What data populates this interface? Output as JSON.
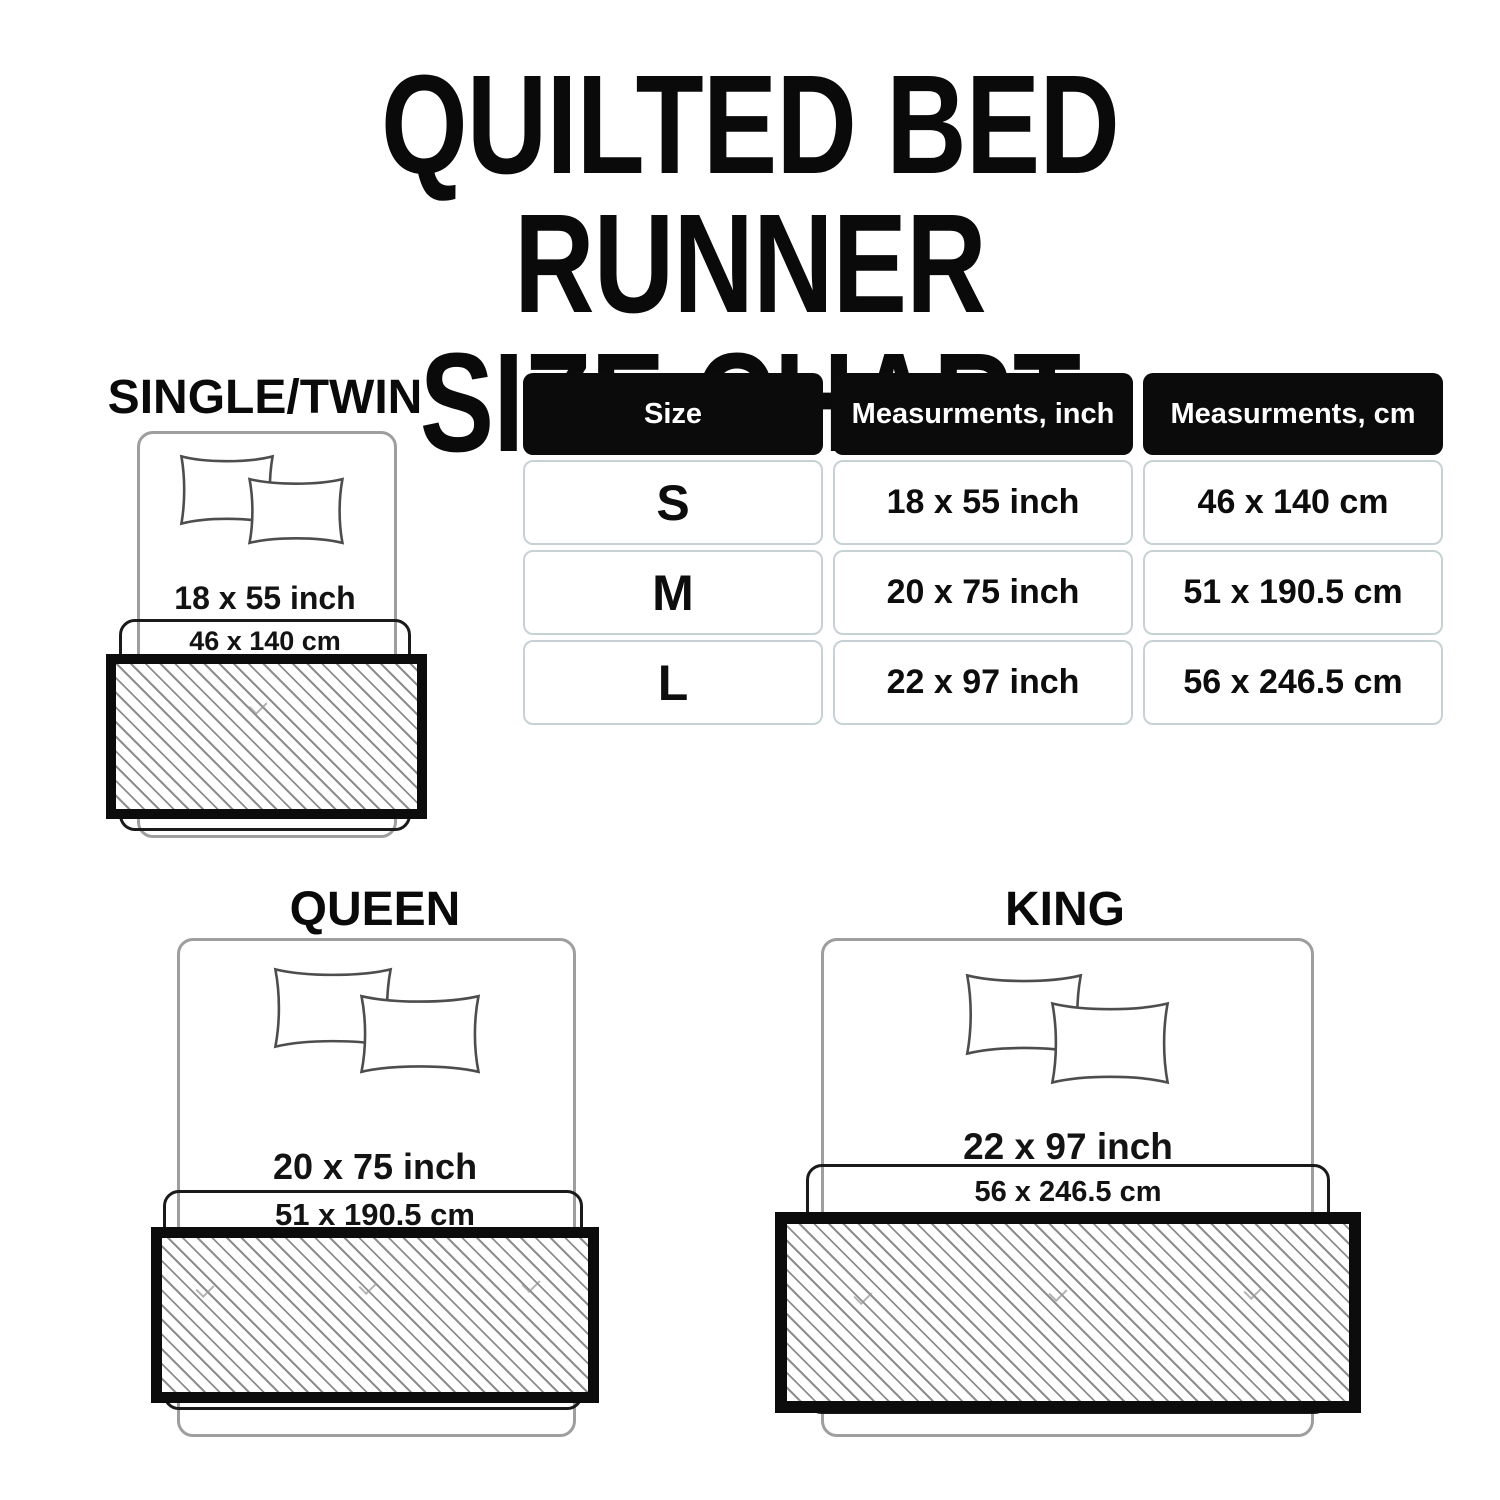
{
  "title": {
    "line1": "QUILTED BED RUNNER",
    "line2": "SIZE CHART"
  },
  "table": {
    "headers": {
      "size": "Size",
      "inch": "Measurments, inch",
      "cm": "Measurments, cm"
    },
    "rows": [
      {
        "size": "S",
        "inch": "18 x 55 inch",
        "cm": "46 x 140 cm"
      },
      {
        "size": "M",
        "inch": "20 x 75 inch",
        "cm": "51 x 190.5 cm"
      },
      {
        "size": "L",
        "inch": "22 x 97 inch",
        "cm": "56 x 246.5 cm"
      }
    ]
  },
  "diagrams": {
    "single": {
      "label": "SINGLE/TWIN",
      "inch": "18 x 55 inch",
      "cm": "46 x 140 cm"
    },
    "queen": {
      "label": "QUEEN",
      "inch": "20 x 75 inch",
      "cm": "51 x 190.5 cm"
    },
    "king": {
      "label": "KING",
      "inch": "22 x 97 inch",
      "cm": "56 x 246.5 cm"
    }
  },
  "colors": {
    "text": "#111111",
    "header_bg": "#0b0b0b",
    "header_text": "#ffffff",
    "cell_border": "#c7d2d4",
    "bed_outline": "#9e9e9e",
    "runner_border": "#0c0c0c",
    "runner_outline": "#1a1a1a",
    "hatch_line": "#8e8e8e"
  }
}
